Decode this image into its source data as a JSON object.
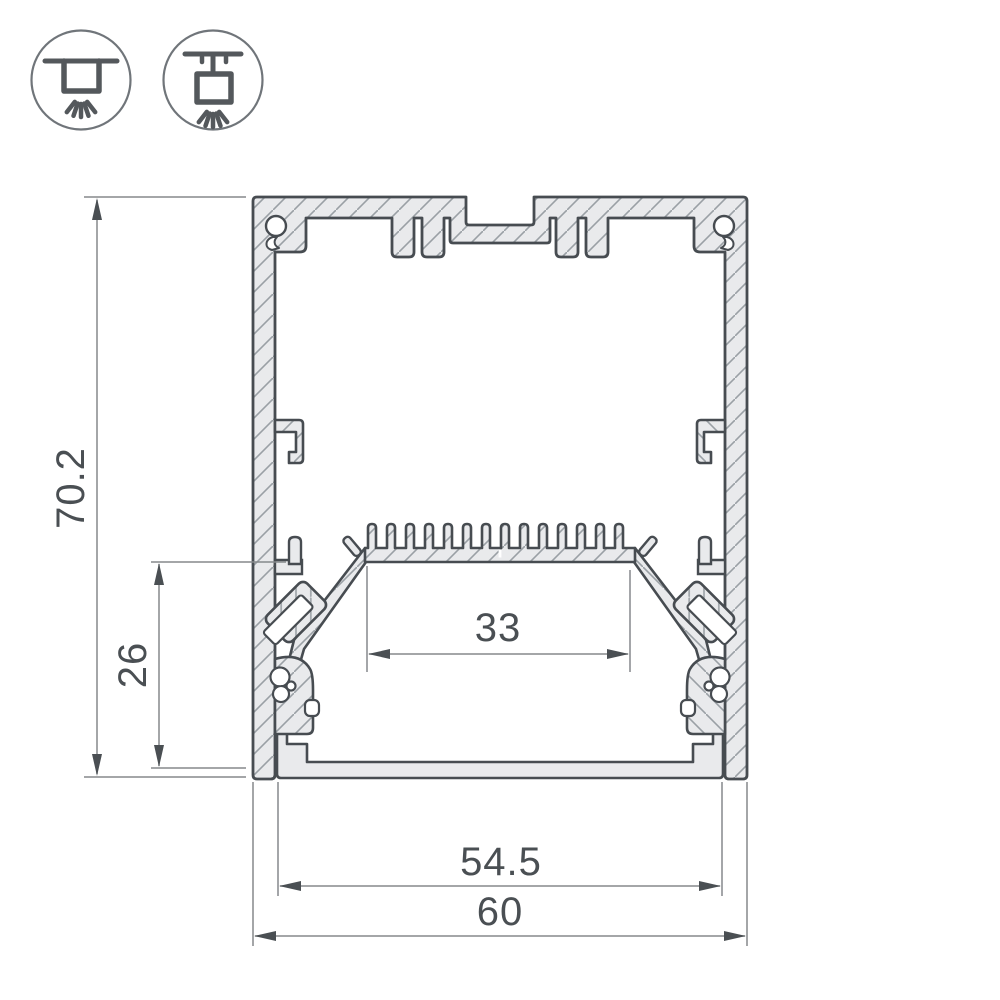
{
  "drawing": {
    "type": "profile-cross-section",
    "dimensions": {
      "overall_height": "70.2",
      "inner_depth": "26",
      "led_shelf_width": "33",
      "inner_width": "54.5",
      "overall_width": "60"
    },
    "icons": [
      {
        "name": "surface-mount-icon",
        "meaning": "surface ceiling mount"
      },
      {
        "name": "pendant-mount-icon",
        "meaning": "suspended pendant mount"
      }
    ],
    "colors": {
      "background": "#ffffff",
      "aluminium_fill": "#e9eaec",
      "outline": "#474c51",
      "hatch_line": "#9aa0a5",
      "dimension_line": "#85898c",
      "dimension_text": "#4a4f53",
      "icon_stroke": "#54585c"
    }
  }
}
